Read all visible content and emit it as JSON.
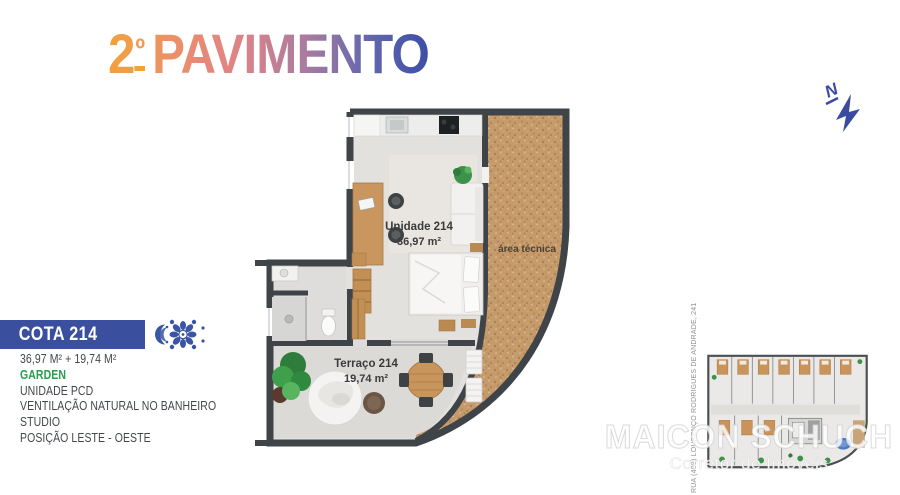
{
  "title": {
    "number": "2",
    "ordinal": "º",
    "word": "PAVIMENTO"
  },
  "compass": {
    "label": "N"
  },
  "floor_plan": {
    "unit_label": "Unidade 214",
    "unit_area": "36,97 m²",
    "technical_area_label": "área técnica",
    "terrace_label": "Terraço 214",
    "terrace_area": "19,74 m²"
  },
  "info_panel": {
    "cota_label": "COTA 214",
    "areas": "36,97 M² + 19,74 M²",
    "highlight": "GARDEN",
    "features": [
      "UNIDADE PCD",
      "VENTILAÇÃO NATURAL NO BANHEIRO",
      "STUDIO",
      "POSIÇÃO LESTE - OESTE"
    ]
  },
  "building_plan": {
    "address": "RUA (408) LOURENÇO RODRIGUES DE ANDRADE, 241"
  },
  "watermark": {
    "name": "MAICON SCHUCH",
    "tagline": "Corretor de Imóveis"
  },
  "colors": {
    "accent_blue": "#3A4F9E",
    "gradient_start": "#F2A23B",
    "gradient_mid": "#DD8387",
    "gradient_end": "#3C4FA6",
    "garden_green": "#27A04C",
    "wall": "#3F4448",
    "cork": "#C59B6C"
  }
}
